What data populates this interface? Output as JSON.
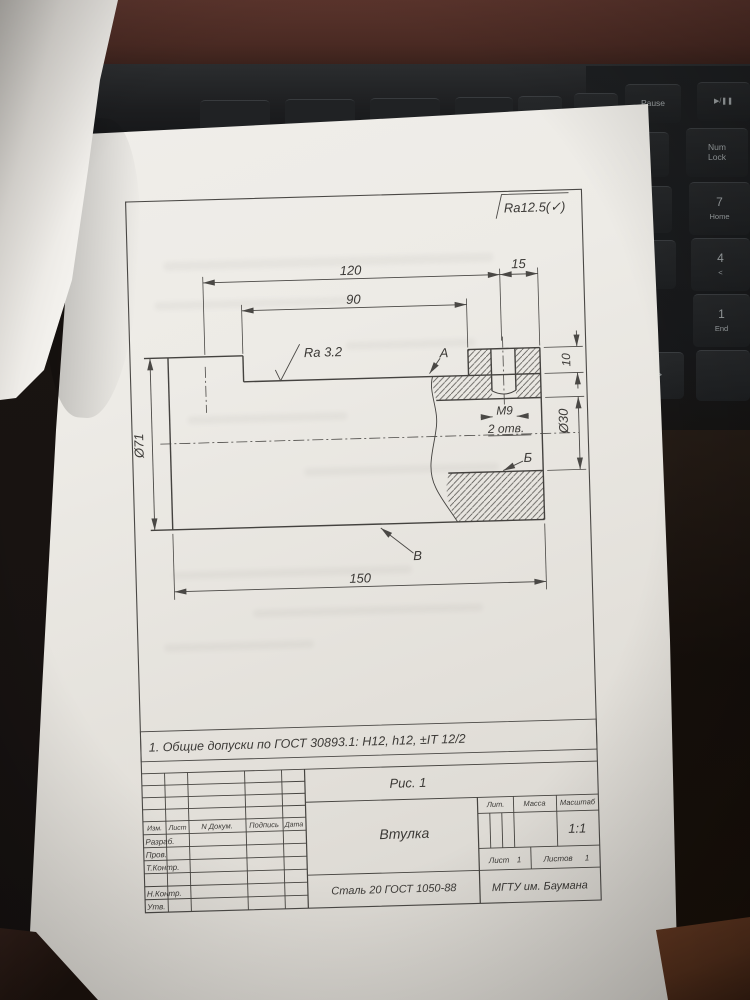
{
  "colors": {
    "paper": "#ece9e4",
    "desk_wood": "#4a2a23",
    "laptop": "#1d1f21",
    "line": "#44423f"
  },
  "drawing": {
    "surface_note": "Ra12.5(✓)",
    "dim_120": "120",
    "dim_15": "15",
    "dim_90": "90",
    "dim_150": "150",
    "dim_d71": "Ø71",
    "dim_d30": "Ø30",
    "dim_10": "10",
    "thread": "М9",
    "holes_note": "2 отв.",
    "roughness": "Ra 3.2",
    "label_a": "А",
    "label_b": "Б",
    "label_v": "В",
    "note": "1. Общие допуски по ГОСТ 30893.1:  H12, h12, ±IT 12/2",
    "caption": "Рис. 1"
  },
  "title_block": {
    "part": "Втулка",
    "material": "Сталь 20 ГОСТ 1050-88",
    "org": "МГТУ им. Баумана",
    "scale": "1:1",
    "col_izm": "Изм.",
    "col_list": "Лист",
    "col_doc": "N Докум.",
    "col_sign": "Подпись",
    "col_date": "Дата",
    "lit": "Лит.",
    "mass": "Масса",
    "scale_hdr": "Масштаб",
    "sheet_label": "Лист",
    "sheet_num": "1",
    "sheets_label": "Листов",
    "sheets_num": "1",
    "row_razrab": "Разраб.",
    "row_prov": "Пров.",
    "row_tkontr": "Т.Контр.",
    "row_nkontr": "Н.Контр.",
    "row_utv": "Утв."
  },
  "keyboard": {
    "prtsc": "PrtSc",
    "scrlk": "ScrLk",
    "pause": "Pause",
    "play": "▶/❚❚",
    "pgup": "PgUp",
    "pgdn": "PgDn",
    "num_top": "Num",
    "num_bottom": "Lock",
    "k7": "7",
    "k7_sub": "Home",
    "k4": "4",
    "k4_sub": "<",
    "k1": "1",
    "k1_sub": "End",
    "arrow": ">"
  }
}
